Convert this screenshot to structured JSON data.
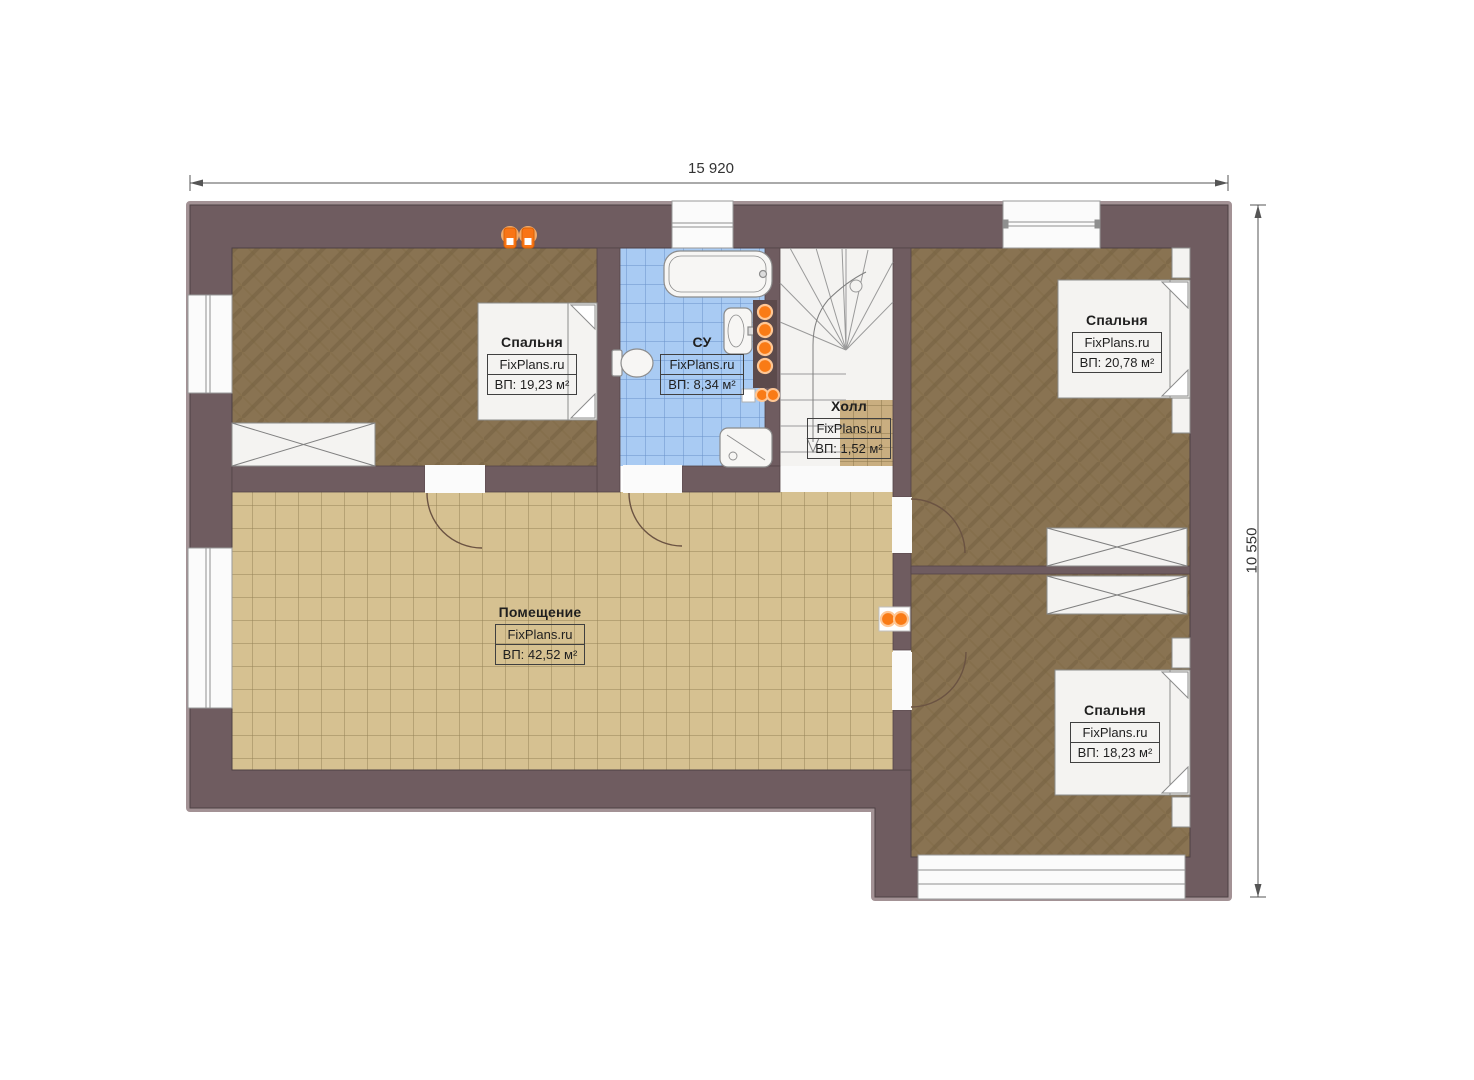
{
  "plan": {
    "type": "floor-plan",
    "dimension_width_label": "15 920",
    "dimension_height_label": "10 550"
  },
  "rooms": [
    {
      "id": "bedroom-1",
      "name": "Спальня",
      "brand": "FixPlans.ru",
      "area": "ВП: 19,23 м²"
    },
    {
      "id": "bathroom",
      "name": "СУ",
      "brand": "FixPlans.ru",
      "area": "ВП: 8,34 м²"
    },
    {
      "id": "hall",
      "name": "Холл",
      "brand": "FixPlans.ru",
      "area": "ВП: 1,52 м²"
    },
    {
      "id": "bedroom-2",
      "name": "Спальня",
      "brand": "FixPlans.ru",
      "area": "ВП: 20,78 м²"
    },
    {
      "id": "main-room",
      "name": "Помещение",
      "brand": "FixPlans.ru",
      "area": "ВП: 42,52 м²"
    },
    {
      "id": "bedroom-3",
      "name": "Спальня",
      "brand": "FixPlans.ru",
      "area": "ВП: 18,23 м²"
    }
  ],
  "colors": {
    "wall": "#6f5c60",
    "wall_outline": "#4e4144",
    "wall_bevel": "#a39295",
    "floor_bedroom": "#897352",
    "floor_main_room": "#d6c191",
    "floor_hall": "#c9ae80",
    "floor_bathroom": "#a9cbf3",
    "fixture_white": "#f4f3f1",
    "radiator_orange": "#f97b16",
    "dimension_line": "#555555"
  }
}
